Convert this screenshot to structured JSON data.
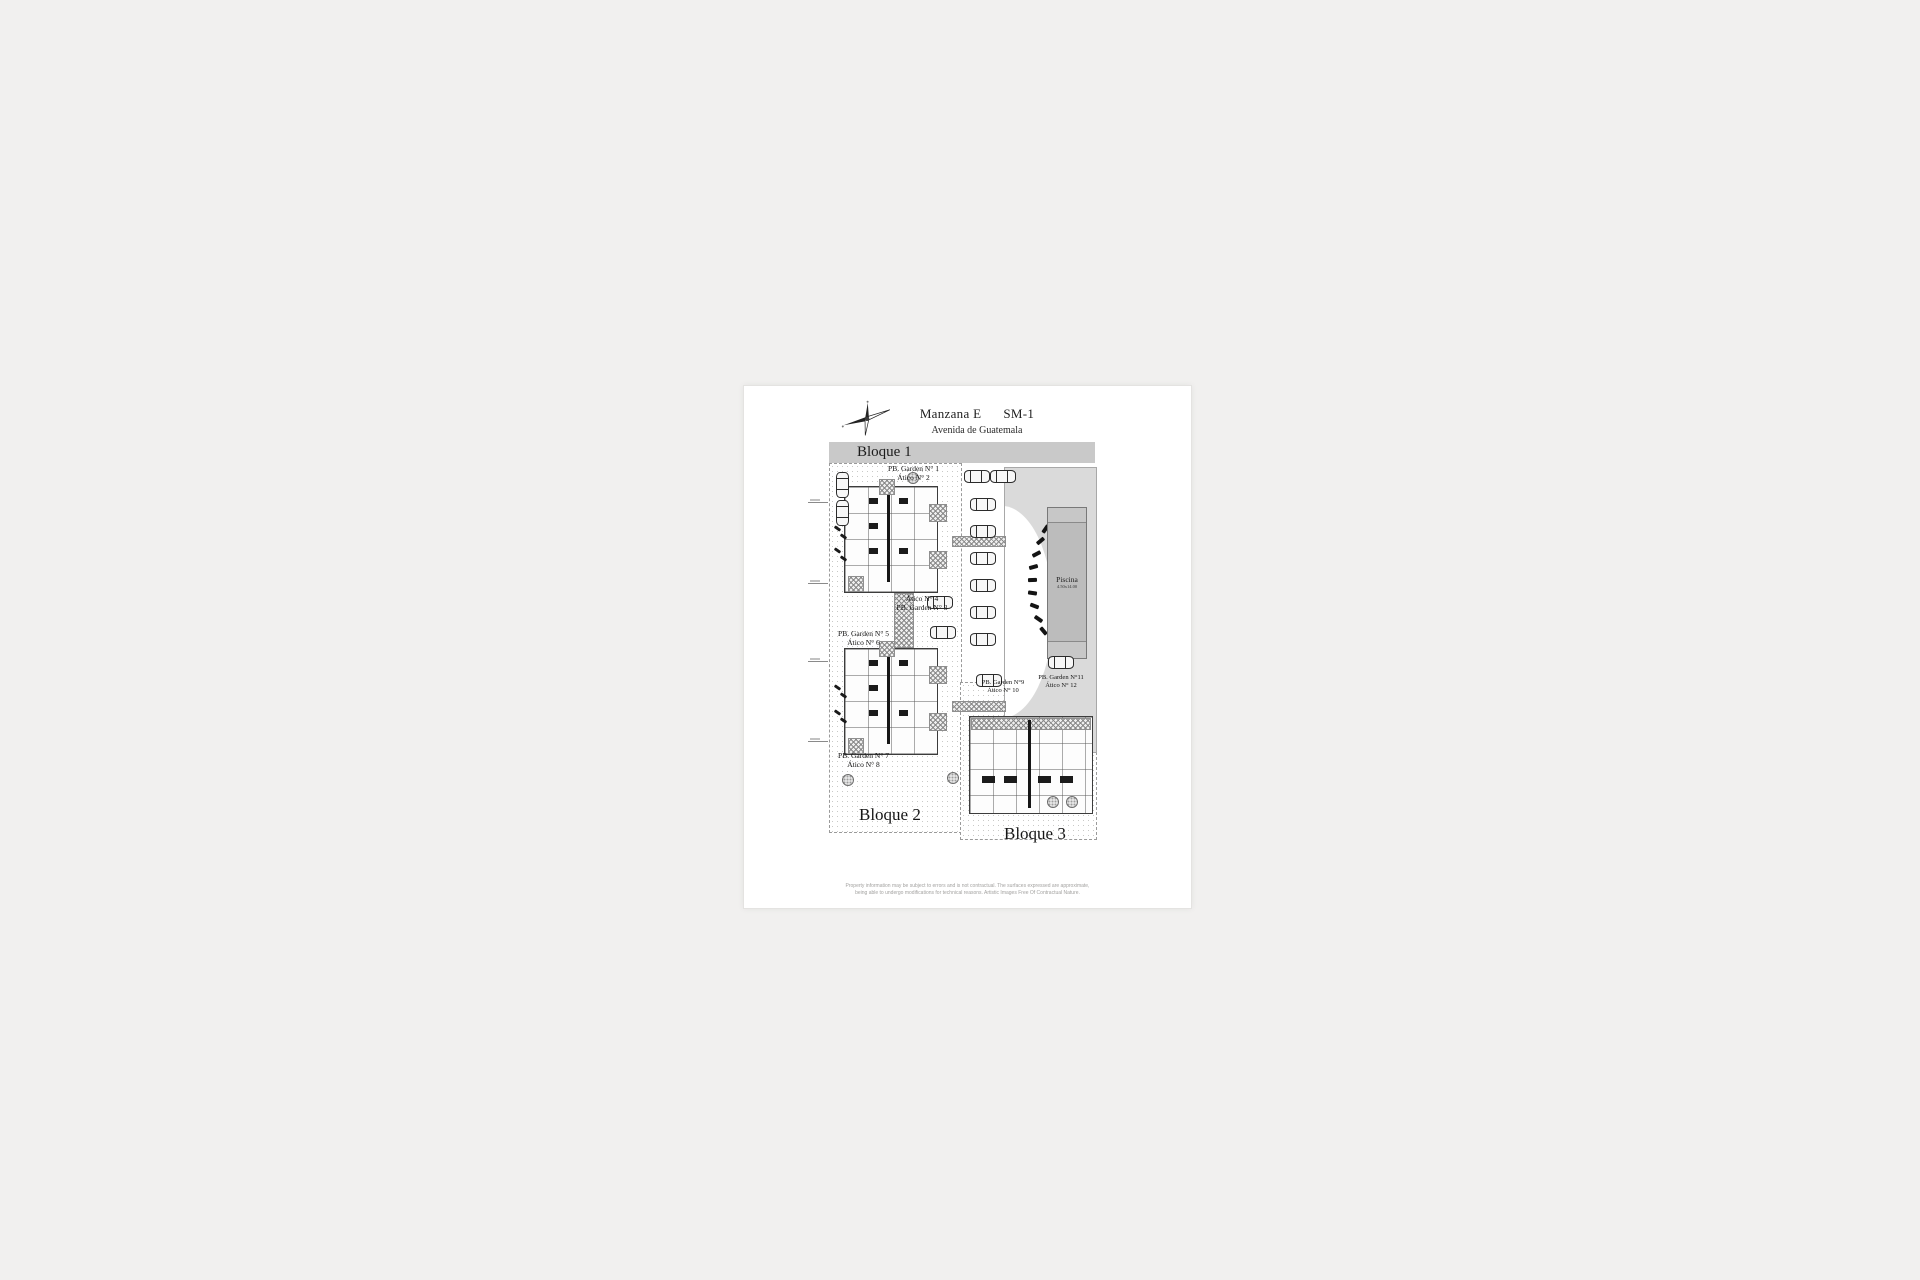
{
  "page": {
    "title": "Manzana E",
    "title_code": "SM-1",
    "street": "Avenida de Guatemala",
    "blocks": {
      "b1": "Bloque 1",
      "b2": "Bloque 2",
      "b3": "Bloque 3"
    },
    "pool": {
      "label": "Piscina",
      "dimensions": "4.50x14.00"
    },
    "units": [
      {
        "line1": "PB. Garden N° 1",
        "line2": "Ático N° 2"
      },
      {
        "line1": "Ático N° 4",
        "line2": "PB. Garden N° 3"
      },
      {
        "line1": "PB. Garden N° 5",
        "line2": "Ático N° 6"
      },
      {
        "line1": "PB. Garden N° 7",
        "line2": "Ático N° 8"
      },
      {
        "line1": "PB. Garden N°9",
        "line2": "Ático N° 10"
      },
      {
        "line1": "PB. Garden N°11",
        "line2": "Ático N° 12"
      }
    ],
    "disclaimer_line1": "Property information may be subject to errors and is not contractual. The surfaces expressed are approximate,",
    "disclaimer_line2": "being able to undergo modifications for technical reasons. Artistic Images Free Of Contractual Nature.",
    "icons": {
      "compass": "compass-rose-icon"
    }
  }
}
